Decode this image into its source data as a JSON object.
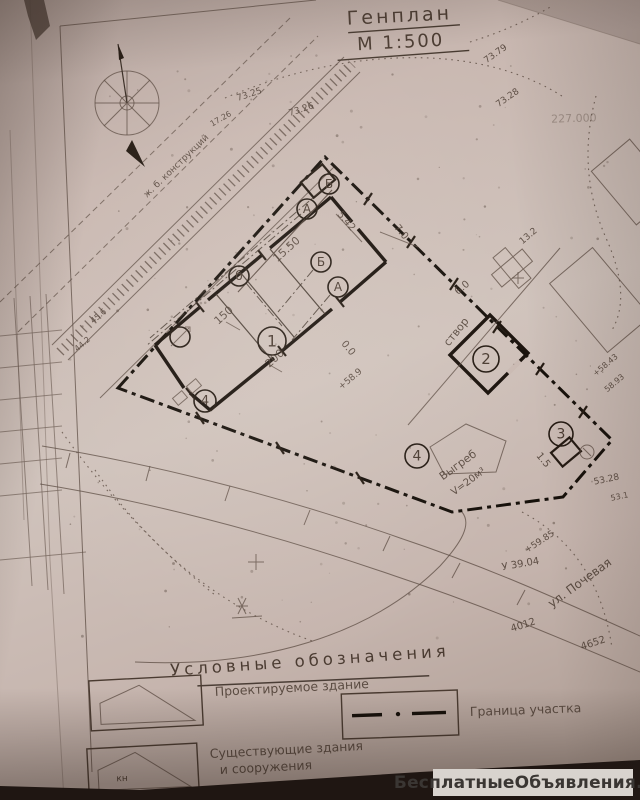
{
  "title": {
    "line1": "Генплан",
    "line2": "М 1:500"
  },
  "legend": {
    "heading": "Условные обозначения",
    "items": [
      {
        "symbol": "projected-building",
        "label": "Проектируемое здание"
      },
      {
        "symbol": "existing-building",
        "label": "Существующие здания",
        "label2": "и сооружения",
        "symbol_text": "кн"
      },
      {
        "symbol": "site-boundary",
        "label": "Граница участка"
      }
    ]
  },
  "watermark": {
    "text": "БесплатныеОбъявления.рф"
  },
  "colors": {
    "paper": "#cabab3",
    "ink": "#4a3b31",
    "wall": "#1a120c",
    "watermark_bg": "#d8d3ce",
    "watermark_text": "#3a3633"
  },
  "plan": {
    "scale_note": "М 1:500",
    "street_label": {
      "t": "ул. Почевая",
      "x": 582,
      "y": 586,
      "rot": -36,
      "s": 12
    },
    "sight_line_label": {
      "t": "створ",
      "x": 459,
      "y": 334,
      "rot": -51,
      "s": 11
    },
    "construction_note": {
      "t": "ж. б. конструкций",
      "x": 178,
      "y": 168,
      "rot": -44,
      "s": 9
    },
    "cesspit": [
      {
        "t": "Выгреб",
        "x": 460,
        "y": 468,
        "rot": -36,
        "s": 11
      },
      {
        "t": "V=20м³",
        "x": 470,
        "y": 484,
        "rot": -36,
        "s": 10
      }
    ],
    "markers": [
      {
        "label": "1",
        "x": 272,
        "y": 341,
        "r": 14
      },
      {
        "label": "2",
        "x": 486,
        "y": 359,
        "r": 13
      },
      {
        "label": "3",
        "x": 561,
        "y": 434,
        "r": 12
      },
      {
        "label": "4",
        "x": 417,
        "y": 456,
        "r": 12
      },
      {
        "label": "4",
        "x": 205,
        "y": 401,
        "r": 11
      },
      {
        "label": "А",
        "x": 307,
        "y": 209,
        "r": 10
      },
      {
        "label": "Б",
        "x": 329,
        "y": 184,
        "r": 10
      },
      {
        "label": "б",
        "x": 239,
        "y": 276,
        "r": 10
      },
      {
        "label": "А",
        "x": 338,
        "y": 287,
        "r": 10
      },
      {
        "label": "Б",
        "x": 321,
        "y": 262,
        "r": 10
      }
    ],
    "dimensions": [
      {
        "t": "15.50",
        "x": 289,
        "y": 252,
        "rot": -42,
        "s": 11
      },
      {
        "t": "150",
        "x": 226,
        "y": 318,
        "rot": -42,
        "s": 11
      },
      {
        "t": "200",
        "x": 277,
        "y": 361,
        "rot": -42,
        "s": 11
      },
      {
        "t": "5.42",
        "x": 344,
        "y": 223,
        "rot": 50,
        "s": 10
      },
      {
        "t": "7.0",
        "x": 399,
        "y": 234,
        "rot": 50,
        "s": 10
      },
      {
        "t": "6.0",
        "x": 464,
        "y": 290,
        "rot": -40,
        "s": 10
      },
      {
        "t": "1.5",
        "x": 541,
        "y": 462,
        "rot": 50,
        "s": 10
      }
    ],
    "elevations": [
      {
        "t": "73.25",
        "x": 250,
        "y": 97,
        "rot": -18,
        "s": 9
      },
      {
        "t": "73.26",
        "x": 302,
        "y": 112,
        "rot": -18,
        "s": 9
      },
      {
        "t": "17.26",
        "x": 222,
        "y": 121,
        "rot": -30,
        "s": 8
      },
      {
        "t": "73.79",
        "x": 497,
        "y": 56,
        "rot": -35,
        "s": 9
      },
      {
        "t": "73.28",
        "x": 509,
        "y": 100,
        "rot": -35,
        "s": 9
      },
      {
        "t": "227.000",
        "x": 574,
        "y": 122,
        "rot": -2,
        "s": 11,
        "faint": true
      },
      {
        "t": "13.2",
        "x": 530,
        "y": 238,
        "rot": -40,
        "s": 9
      },
      {
        "t": "+58.9",
        "x": 352,
        "y": 381,
        "rot": -40,
        "s": 9
      },
      {
        "t": "0.0",
        "x": 346,
        "y": 350,
        "rot": 50,
        "s": 10
      },
      {
        "t": "+58.43",
        "x": 607,
        "y": 367,
        "rot": -40,
        "s": 8
      },
      {
        "t": "58.93",
        "x": 616,
        "y": 385,
        "rot": -40,
        "s": 8
      },
      {
        "t": "53.28",
        "x": 607,
        "y": 482,
        "rot": -12,
        "s": 9
      },
      {
        "t": "53.1",
        "x": 620,
        "y": 499,
        "rot": -12,
        "s": 8
      },
      {
        "t": "+59.85",
        "x": 541,
        "y": 544,
        "rot": -33,
        "s": 9
      },
      {
        "t": "У 39.04",
        "x": 521,
        "y": 567,
        "rot": -10,
        "s": 10
      },
      {
        "t": "4012",
        "x": 524,
        "y": 628,
        "rot": -18,
        "s": 10
      },
      {
        "t": "4652",
        "x": 594,
        "y": 646,
        "rot": -18,
        "s": 10
      },
      {
        "t": "45.6",
        "x": 100,
        "y": 318,
        "rot": -40,
        "s": 8
      },
      {
        "t": "44.2",
        "x": 84,
        "y": 346,
        "rot": -40,
        "s": 8
      }
    ]
  }
}
